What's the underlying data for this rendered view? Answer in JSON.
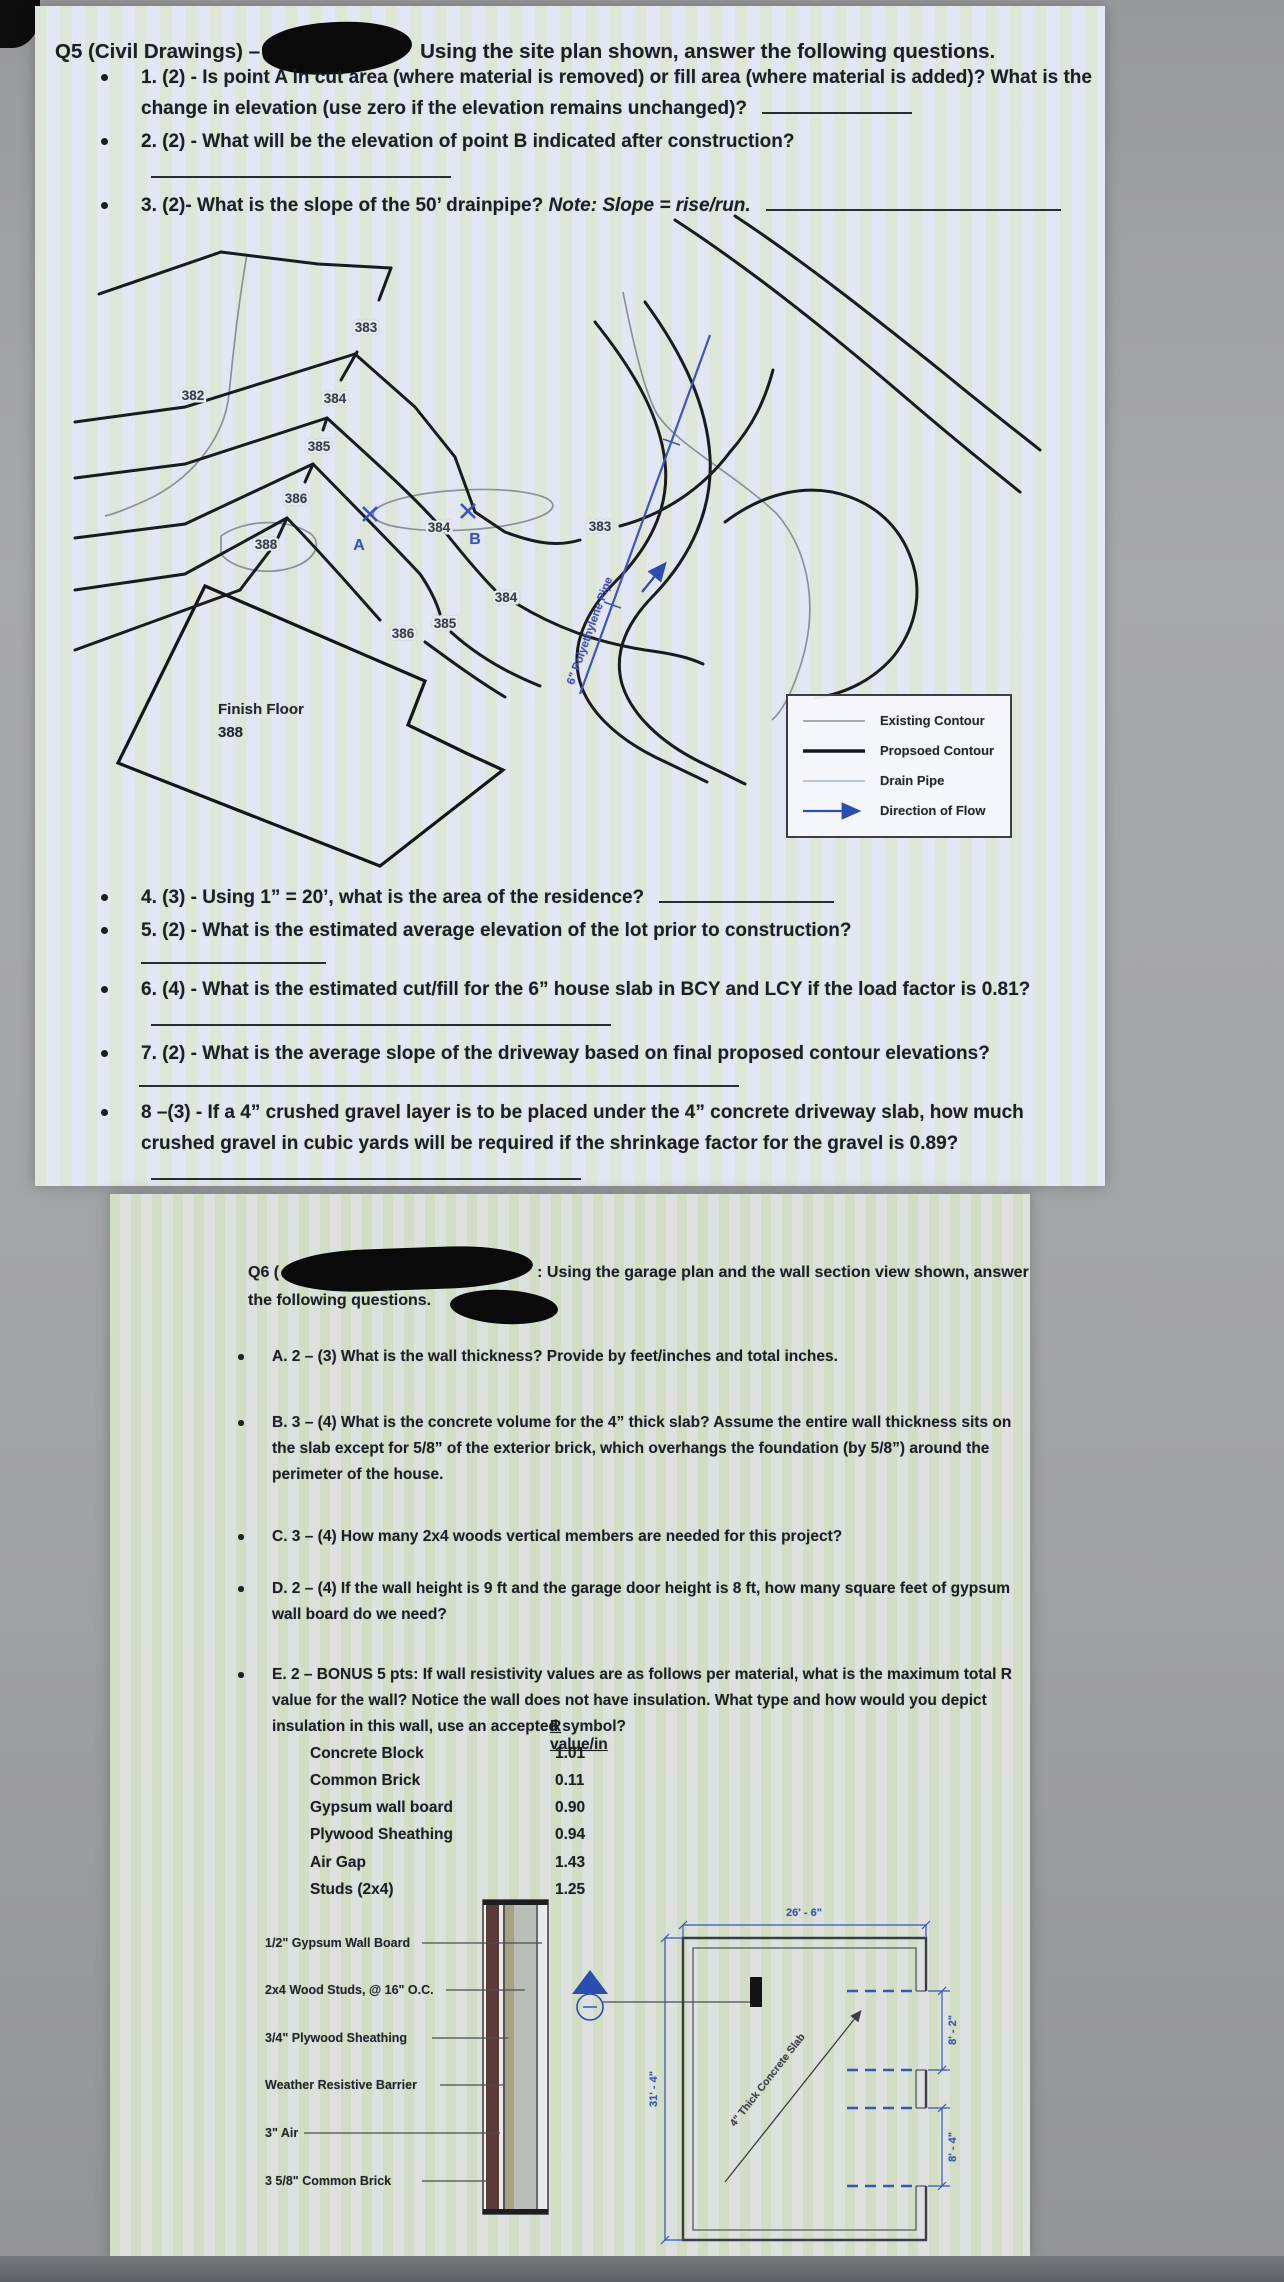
{
  "q5": {
    "title": {
      "prefix": "Q5 (Civil Drawings) –",
      "suffix": "Using the site plan shown, answer the following questions."
    },
    "questions": [
      {
        "text": "1. (2) - Is point A in cut area (where material is removed) or fill area (where material is added)? What is the change in elevation (use zero if the elevation remains unchanged)?"
      },
      {
        "text": "2. (2) - What will be the elevation of point B indicated after construction?"
      },
      {
        "text": "3. (2)- What is the slope of the 50’ drainpipe? ",
        "note": "Note: Slope = rise/run."
      },
      {
        "text": "4. (3) - Using 1” = 20’, what is the area of the residence?"
      },
      {
        "text": "5. (2) - What is the estimated average elevation of the lot prior to construction?"
      },
      {
        "text": "6. (4) - What is the estimated cut/fill for the 6” house slab in BCY and LCY if the load factor is 0.81?"
      },
      {
        "text": "7. (2) - What is the average slope of the driveway based on final proposed contour elevations?"
      },
      {
        "text": "8 –(3) - If a 4” crushed gravel layer is to be placed under the 4” concrete driveway slab, how much crushed gravel in cubic yards will be required if the shrinkage factor for the gravel is 0.89?"
      }
    ],
    "site_plan": {
      "finish_floor": {
        "line1": "Finish Floor",
        "line2": "388"
      },
      "points": {
        "a": "A",
        "b": "B"
      },
      "pipe_label": "6\" Polyethylene Pipe",
      "contour_labels": {
        "ridge_383": "383",
        "left_382": "382",
        "ridge_384": "384",
        "ridge_385": "385",
        "ridge_386": "386",
        "loop_388": "388",
        "mid_383": "383",
        "b_384": "384",
        "right_384": "384",
        "right_385": "385",
        "right_386": "386"
      },
      "legend": {
        "existing": "Existing Contour",
        "proposed": "Propsoed Contour",
        "drain": "Drain Pipe",
        "flow": "Direction of Flow"
      }
    }
  },
  "q6": {
    "header": {
      "prefix": "Q6 (",
      "suffix": ": Using the garage plan and the wall section view shown, answer",
      "line2": "the following questions."
    },
    "questions": [
      {
        "text": "A. 2 – (3) What is the wall thickness?  Provide by feet/inches and total inches."
      },
      {
        "text": "B. 3 – (4) What is the concrete volume for the 4” thick slab? Assume the entire wall thickness sits on the slab except for 5/8” of the exterior brick, which overhangs the foundation (by 5/8”) around the perimeter of the house."
      },
      {
        "text": "C. 3 – (4) How many 2x4 woods vertical members are needed for this project?"
      },
      {
        "text": "D. 2 – (4) If the wall height is 9 ft and the garage door height is 8 ft, how many square feet of gypsum wall board do we need?"
      },
      {
        "text": "E. 2 – BONUS 5 pts:  If wall resistivity values are as follows per material, what is the maximum total R value for the wall?  Notice the wall does not have insulation.  What type and how would you depict insulation in this wall, use an accepted symbol?"
      }
    ],
    "r_table": {
      "header": "R value/in",
      "rows": [
        {
          "material": "Concrete Block",
          "value": "1.01"
        },
        {
          "material": "Common Brick",
          "value": "0.11"
        },
        {
          "material": "Gypsum wall board",
          "value": "0.90"
        },
        {
          "material": "Plywood Sheathing",
          "value": "0.94"
        },
        {
          "material": "Air Gap",
          "value": "1.43"
        },
        {
          "material": "Studs (2x4)",
          "value": "1.25"
        }
      ]
    },
    "figure": {
      "wall_labels": [
        "1/2\" Gypsum Wall Board",
        "2x4 Wood Studs, @ 16\" O.C.",
        "3/4\" Plywood Sheathing",
        "Weather Resistive Barrier",
        "3\" Air",
        "3 5/8\" Common Brick"
      ],
      "plan": {
        "dim_top": "26' - 6\"",
        "dim_left": "31' - 4\"",
        "dim_right_top": "8' - 2\"",
        "dim_right_bottom": "8' - 4\"",
        "slab_label": "4\" Thick Concrete Slab"
      }
    }
  }
}
